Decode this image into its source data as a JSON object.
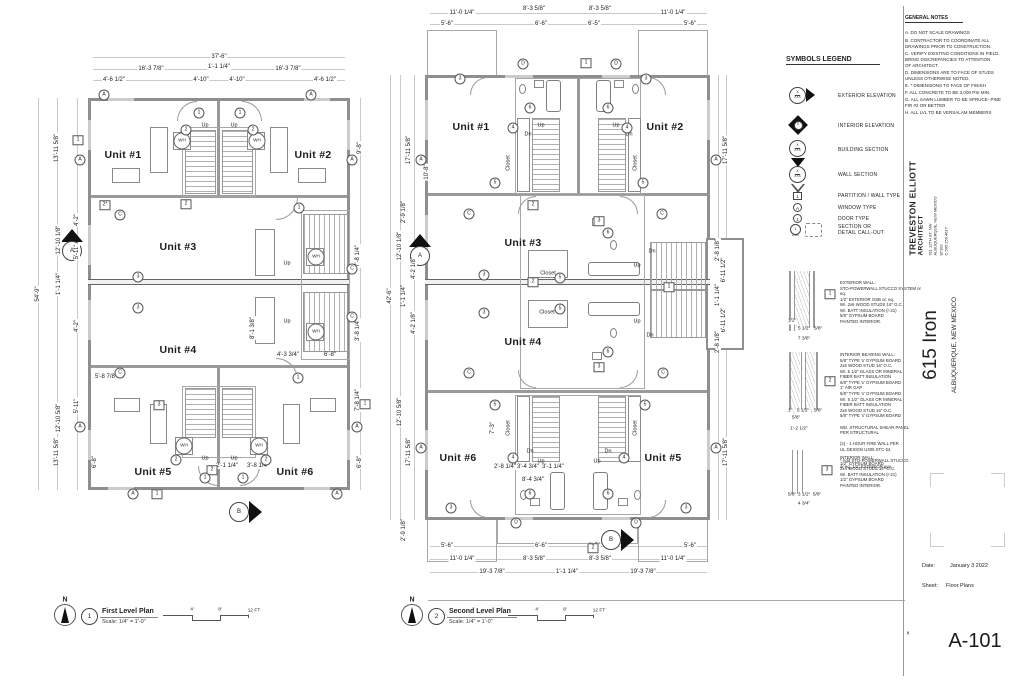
{
  "sheet": {
    "number": "A-101",
    "date_label": "Date:",
    "date_value": "January 3 2022",
    "sheet_label": "Sheet:",
    "sheet_value": "Floor Plans",
    "corner_mark": "x"
  },
  "title_block": {
    "architect_name": "TREVESTON ELLIOTT",
    "architect_role": "ARCHITECT",
    "address_lines": "611 12TH ST. NW\nALBUQUERQUE, NEW MEXICO\n87102\nC 505.259.4617",
    "project_name": "615 Iron",
    "project_location": "ALBUQUERQUE, NEW MEXICO"
  },
  "general_notes": {
    "title": "GENERAL NOTES",
    "items": [
      "A. DO NOT SCALE DRAWINGS",
      "B. CONTRACTOR TO COORDINATE ALL\n      DRAWINGS PRIOR TO CONSTRUCTION.",
      "C. VERIFY EXISTING CONDITIONS IN FIELD.\n      BRING DISCREPANCIES TO ATTENTION\n      OF ARCHITECT.",
      "D. DIMENSIONS ARE TO FACE OF STUDS\n      UNLESS OTHERWISE NOTED.",
      "E. * DIMENSIONS TO FACE OF FINISH",
      "F. ALL CONCRETE TO BE 3,000 PSI MIN.",
      "G. ALL SAWN LUMBER TO BE SPRUCE- PINE\n      FIR #2 OR BETTER",
      "H. ALL LVL TO BE VERSALAM MEMBERS"
    ]
  },
  "symbols_legend": {
    "title": "SYMBOLS LEGEND",
    "items": [
      {
        "label": "EXTERIOR ELEVATION",
        "t": "X",
        "b": "XXX"
      },
      {
        "label": "INTERIOR ELEVATION",
        "t": "X",
        "b": "XXXX"
      },
      {
        "label": "BUILDING SECTION",
        "t": "X",
        "b": "XXX"
      },
      {
        "label": "WALL SECTION",
        "t": "X",
        "b": "XXX"
      },
      {
        "label": "PARTITION / WALL TYPE",
        "tag": "1"
      },
      {
        "label": "WINDOW TYPE",
        "tag": "A"
      },
      {
        "label": "DOOR TYPE",
        "tag": "1"
      },
      {
        "label": "SECTION OR\nDETAIL CALL-OUT",
        "tag": "1",
        "sub": "A-RG"
      }
    ]
  },
  "wall_notes": {
    "n1": "EXTERIOR WALL:\nSTO-POWERWALL STUCCO SYSTEM or eq.\n1/2\" EXTERIOR OSB or. eq.\nW/. 2x6 WOOD STUDS 16\" O.C.\nW/. BATT INSULATION (r-21)\n5/8\" GYPSUM BOARD\nPAINTED INTERIOR.",
    "n2": "INTERIOR BEARING WALL:\n5/8\" TYPE 'x' GYPSUM BOARD\n2x6 WOOD STUD 16\" O.C.\nW/. 5 1/2\" GLASS OR MINERAL\nFIBER BATT INSULATION\n5/8\" TYPE 'x' GYPSUM BOARD\n1\" AIR GAP\n5/8\" TYPE 'x' GYPSUM BOARD\nW/. 5 1/2\" GLASS OR MINERAL\nFIBER BATT INSULATION\n2x6 WOOD STUD 16\" O.C.\n5/8\" TYPE 'x' GYPSUM BOARD\n\nWD. STRUCTURAL SHEAR PANEL\nPER STRUCTURAL\n\n(2) - 1 HOUR FIRE WALL PER\n        UL DESIGN U305 STC 64.\n\n* Add STO-POWERWALL STUCCO\n   or eq. 1/2\" EXTERIOR gyp.",
    "n3": "INTERIOR WALL:\n1/2\" GYPSUM BOARD\n2x4 WOOD STUDS 16\" O.C.\nW/. BATT INSULATION (r-21)\n1/2\" GYPSUM BOARD\nPAINTED INTERIOR."
  },
  "plans": [
    {
      "num": "1",
      "title": "First Level Plan",
      "scale": "Scale: 1/4\" = 1'-0\"",
      "north": "N"
    },
    {
      "num": "2",
      "title": "Second Level Plan",
      "scale": "Scale: 1/4\" = 1'-0\"",
      "north": "N"
    }
  ],
  "labels": [
    [
      "37'-6\"",
      219,
      57,
      "d"
    ],
    [
      "16'-3 7/8\"",
      151,
      69,
      "d"
    ],
    [
      "1'-1 1/4\"",
      219,
      67,
      "d"
    ],
    [
      "16'-3 7/8\"",
      288,
      69,
      "d"
    ],
    [
      "4'-6 1/2\"",
      114,
      80,
      "d"
    ],
    [
      "4'-10\"",
      201,
      80,
      "d"
    ],
    [
      "4'-10\"",
      237,
      80,
      "d"
    ],
    [
      "4'-6 1/2\"",
      325,
      80,
      "d"
    ],
    [
      "13'-11 5/8\"",
      57,
      148,
      "dv"
    ],
    [
      "54'-9\"",
      38,
      294,
      "dv"
    ],
    [
      "4'-2\"",
      77,
      220,
      "dv"
    ],
    [
      "12'-10 1/8\"",
      59,
      240,
      "dv"
    ],
    [
      "5'-11\"",
      77,
      252,
      "dv"
    ],
    [
      "1'-1 1/4\"",
      59,
      284,
      "dv"
    ],
    [
      "4'-2\"",
      77,
      326,
      "dv"
    ],
    [
      "12'-10 5/8\"",
      59,
      418,
      "dv"
    ],
    [
      "5'-11\"",
      77,
      406,
      "dv"
    ],
    [
      "13'-11 5/8\"",
      57,
      452,
      "dv"
    ],
    [
      "6'-8\"",
      95,
      462,
      "dv"
    ],
    [
      "9'-8\"",
      360,
      148,
      "dv"
    ],
    [
      "7'-8 1/4\"",
      358,
      256,
      "dv"
    ],
    [
      "3'-8 1/4\"",
      358,
      330,
      "dv"
    ],
    [
      "7'-8 1/4\"",
      358,
      400,
      "dv"
    ],
    [
      "6'-8\"",
      360,
      462,
      "dv"
    ],
    [
      "5'-8 7/8\"",
      106,
      377,
      "d"
    ],
    [
      "4'-3 3/4\"",
      288,
      355,
      "d"
    ],
    [
      "6'-8\"",
      330,
      355,
      "d"
    ],
    [
      "8'-1 3/8\"",
      253,
      328,
      "dv"
    ],
    [
      "2'-1 1/4\"",
      227,
      466,
      "d"
    ],
    [
      "3'-8 1/4\"",
      258,
      466,
      "d"
    ],
    [
      "Unit #1",
      123,
      155,
      "u"
    ],
    [
      "Unit #2",
      313,
      155,
      "u"
    ],
    [
      "Unit #3",
      178,
      247,
      "u"
    ],
    [
      "Unit #4",
      178,
      350,
      "u"
    ],
    [
      "Unit #5",
      153,
      472,
      "u"
    ],
    [
      "Unit #6",
      295,
      472,
      "u"
    ],
    [
      "Up",
      205,
      126,
      "tx"
    ],
    [
      "Up",
      234,
      126,
      "tx"
    ],
    [
      "Up",
      287,
      264,
      "tx"
    ],
    [
      "Up",
      287,
      322,
      "tx"
    ],
    [
      "Up",
      205,
      459,
      "tx"
    ],
    [
      "Up",
      234,
      459,
      "tx"
    ],
    [
      "WH",
      182,
      141,
      "wh"
    ],
    [
      "WH",
      257,
      141,
      "wh"
    ],
    [
      "WH",
      316,
      257,
      "wh"
    ],
    [
      "WH",
      316,
      332,
      "wh"
    ],
    [
      "WH",
      184,
      446,
      "wh"
    ],
    [
      "WH",
      259,
      446,
      "wh"
    ],
    [
      "1",
      78,
      140,
      "sq"
    ],
    [
      "2*",
      105,
      205,
      "sq"
    ],
    [
      "2",
      186,
      204,
      "sq"
    ],
    [
      "3",
      159,
      405,
      "sq"
    ],
    [
      "1",
      365,
      404,
      "sq"
    ],
    [
      "2",
      212,
      470,
      "sq"
    ],
    [
      "1",
      157,
      494,
      "sq"
    ],
    [
      "A",
      104,
      95,
      "ci"
    ],
    [
      "A",
      311,
      95,
      "ci"
    ],
    [
      "1",
      199,
      113,
      "ci"
    ],
    [
      "1",
      240,
      113,
      "ci"
    ],
    [
      "2",
      186,
      130,
      "ci"
    ],
    [
      "2",
      253,
      130,
      "ci"
    ],
    [
      "A",
      80,
      160,
      "ci"
    ],
    [
      "A",
      352,
      160,
      "ci"
    ],
    [
      "C",
      120,
      215,
      "ci"
    ],
    [
      "3",
      138,
      277,
      "ci"
    ],
    [
      "3",
      138,
      308,
      "ci"
    ],
    [
      "C",
      120,
      373,
      "ci"
    ],
    [
      "C",
      352,
      269,
      "ci"
    ],
    [
      "C",
      352,
      317,
      "ci"
    ],
    [
      "1",
      299,
      208,
      "ci"
    ],
    [
      "1",
      298,
      378,
      "ci"
    ],
    [
      "2",
      176,
      460,
      "ci"
    ],
    [
      "2",
      266,
      460,
      "ci"
    ],
    [
      "1",
      205,
      478,
      "ci"
    ],
    [
      "1",
      243,
      478,
      "ci"
    ],
    [
      "A",
      80,
      427,
      "ci"
    ],
    [
      "A",
      357,
      427,
      "ci"
    ],
    [
      "A",
      133,
      494,
      "ci"
    ],
    [
      "A",
      337,
      494,
      "ci"
    ],
    [
      "A",
      72,
      251,
      "mk"
    ],
    [
      "B",
      239,
      512,
      "mk"
    ],
    [
      "4'",
      192,
      611,
      "st"
    ],
    [
      "8'",
      220,
      611,
      "st"
    ],
    [
      "12 FT",
      254,
      612,
      "st"
    ],
    [
      "11'-0 1/4\"",
      462,
      13,
      "d"
    ],
    [
      "8'-3 5/8\"",
      534,
      9,
      "d"
    ],
    [
      "8'-3 5/8\"",
      600,
      9,
      "d"
    ],
    [
      "11'-0 1/4\"",
      673,
      13,
      "d"
    ],
    [
      "5'-6\"",
      447,
      24,
      "d"
    ],
    [
      "6'-6\"",
      541,
      24,
      "d"
    ],
    [
      "6'-5\"",
      594,
      24,
      "d"
    ],
    [
      "5'-6\"",
      690,
      24,
      "d"
    ],
    [
      "17'-11 5/8\"",
      409,
      150,
      "dv"
    ],
    [
      "10'-8\"",
      427,
      172,
      "dv"
    ],
    [
      "42'-6\"",
      390,
      296,
      "dv"
    ],
    [
      "2'-9 1/8\"",
      404,
      212,
      "dv"
    ],
    [
      "12'-10 1/8\"",
      400,
      246,
      "dv"
    ],
    [
      "4'-2 1/8\"",
      414,
      268,
      "dv"
    ],
    [
      "1'-1 1/4\"",
      404,
      296,
      "dv"
    ],
    [
      "4'-2 1/8\"",
      414,
      323,
      "dv"
    ],
    [
      "12'-10 5/8\"",
      400,
      412,
      "dv"
    ],
    [
      "17'-11 5/8\"",
      409,
      452,
      "dv"
    ],
    [
      "2'-9 1/8\"",
      404,
      530,
      "dv"
    ],
    [
      "17'-11 5/8\"",
      726,
      150,
      "dv"
    ],
    [
      "2'-8 1/8\"",
      718,
      250,
      "dv"
    ],
    [
      "6'-11 1/2\"",
      724,
      270,
      "dv"
    ],
    [
      "1'-1 1/4\"",
      718,
      295,
      "dv"
    ],
    [
      "6'-11 1/2\"",
      724,
      320,
      "dv"
    ],
    [
      "2'-8 1/8\"",
      718,
      342,
      "dv"
    ],
    [
      "17'-11 5/8\"",
      726,
      452,
      "dv"
    ],
    [
      "5'-6\"",
      447,
      546,
      "d"
    ],
    [
      "6'-6\"",
      541,
      546,
      "d"
    ],
    [
      "6'-5\"",
      594,
      546,
      "d"
    ],
    [
      "5'-6\"",
      690,
      546,
      "d"
    ],
    [
      "11'-0 1/4\"",
      462,
      559,
      "d"
    ],
    [
      "8'-3 5/8\"",
      534,
      559,
      "d"
    ],
    [
      "8'-3 5/8\"",
      600,
      559,
      "d"
    ],
    [
      "11'-0 1/4\"",
      673,
      559,
      "d"
    ],
    [
      "19'-3 7/8\"",
      492,
      572,
      "d"
    ],
    [
      "1'-1 1/4\"",
      567,
      572,
      "d"
    ],
    [
      "19'-3 7/8\"",
      643,
      572,
      "d"
    ],
    [
      "Unit #1",
      471,
      127,
      "u"
    ],
    [
      "Unit #2",
      665,
      127,
      "u"
    ],
    [
      "Unit #3",
      523,
      243,
      "u"
    ],
    [
      "Unit #4",
      523,
      342,
      "u"
    ],
    [
      "Unit #6",
      458,
      458,
      "u"
    ],
    [
      "Unit #5",
      663,
      458,
      "u"
    ],
    [
      "Up",
      541,
      126,
      "tx"
    ],
    [
      "Dn",
      528,
      135,
      "tx"
    ],
    [
      "Up",
      616,
      126,
      "tx"
    ],
    [
      "Dn",
      629,
      135,
      "tx"
    ],
    [
      "Dn",
      652,
      252,
      "tx"
    ],
    [
      "Up",
      637,
      266,
      "tx"
    ],
    [
      "Up",
      637,
      322,
      "tx"
    ],
    [
      "Dn",
      650,
      336,
      "tx"
    ],
    [
      "Dn",
      530,
      452,
      "tx"
    ],
    [
      "Up",
      541,
      462,
      "tx"
    ],
    [
      "Dn",
      608,
      452,
      "tx"
    ],
    [
      "Up",
      597,
      462,
      "tx"
    ],
    [
      "Closet",
      509,
      163,
      "txv"
    ],
    [
      "Closet",
      636,
      163,
      "txv"
    ],
    [
      "Closet",
      548,
      274,
      "tx"
    ],
    [
      "Closet",
      547,
      313,
      "tx"
    ],
    [
      "Closet",
      509,
      428,
      "txv"
    ],
    [
      "Closet",
      636,
      428,
      "txv"
    ],
    [
      "2'-8 1/4\"",
      505,
      467,
      "d"
    ],
    [
      "3'-4 3/4\"",
      528,
      467,
      "d"
    ],
    [
      "3'-1 1/4\"",
      553,
      467,
      "d"
    ],
    [
      "8'-4 3/4\"",
      533,
      480,
      "d"
    ],
    [
      "7'-3\"",
      493,
      428,
      "dv"
    ],
    [
      "3",
      460,
      79,
      "ci"
    ],
    [
      "3",
      646,
      79,
      "ci"
    ],
    [
      "D",
      523,
      64,
      "ci"
    ],
    [
      "D",
      616,
      64,
      "ci"
    ],
    [
      "6",
      530,
      108,
      "ci"
    ],
    [
      "6",
      608,
      108,
      "ci"
    ],
    [
      "4",
      513,
      128,
      "ci"
    ],
    [
      "4",
      627,
      128,
      "ci"
    ],
    [
      "5",
      495,
      183,
      "ci"
    ],
    [
      "5",
      643,
      183,
      "ci"
    ],
    [
      "A",
      421,
      160,
      "ci"
    ],
    [
      "A",
      716,
      160,
      "ci"
    ],
    [
      "C",
      469,
      214,
      "ci"
    ],
    [
      "C",
      662,
      214,
      "ci"
    ],
    [
      "3",
      484,
      275,
      "ci"
    ],
    [
      "3",
      484,
      313,
      "ci"
    ],
    [
      "5",
      560,
      278,
      "ci"
    ],
    [
      "5",
      560,
      309,
      "ci"
    ],
    [
      "6",
      608,
      233,
      "ci"
    ],
    [
      "6",
      608,
      352,
      "ci"
    ],
    [
      "C",
      469,
      373,
      "ci"
    ],
    [
      "C",
      663,
      373,
      "ci"
    ],
    [
      "A",
      421,
      448,
      "ci"
    ],
    [
      "A",
      716,
      448,
      "ci"
    ],
    [
      "5",
      495,
      405,
      "ci"
    ],
    [
      "5",
      645,
      405,
      "ci"
    ],
    [
      "4",
      513,
      458,
      "ci"
    ],
    [
      "4",
      624,
      458,
      "ci"
    ],
    [
      "6",
      530,
      494,
      "ci"
    ],
    [
      "6",
      608,
      494,
      "ci"
    ],
    [
      "3",
      451,
      508,
      "ci"
    ],
    [
      "3",
      686,
      508,
      "ci"
    ],
    [
      "D",
      516,
      523,
      "ci"
    ],
    [
      "D",
      636,
      523,
      "ci"
    ],
    [
      "1",
      586,
      63,
      "sq"
    ],
    [
      "3",
      599,
      221,
      "sq"
    ],
    [
      "2",
      533,
      205,
      "sq"
    ],
    [
      "2",
      533,
      282,
      "sq"
    ],
    [
      "1",
      669,
      287,
      "sq"
    ],
    [
      "3",
      599,
      367,
      "sq"
    ],
    [
      "2",
      593,
      548,
      "sq"
    ],
    [
      "A",
      420,
      256,
      "mk"
    ],
    [
      "B",
      611,
      540,
      "mk"
    ],
    [
      "4'",
      537,
      611,
      "st"
    ],
    [
      "8'",
      565,
      611,
      "st"
    ],
    [
      "12 FT",
      599,
      612,
      "st"
    ],
    [
      "1/2\"",
      792,
      322,
      "st"
    ],
    [
      "5 1/2\"",
      804,
      330,
      "st"
    ],
    [
      "5/8\"",
      818,
      330,
      "st"
    ],
    [
      "7 3/8\"",
      804,
      340,
      "st"
    ],
    [
      "1\"",
      790,
      412,
      "st"
    ],
    [
      "5 1/2\"",
      803,
      412,
      "st"
    ],
    [
      "5/8\"",
      818,
      412,
      "st"
    ],
    [
      "5/8\"",
      796,
      419,
      "st"
    ],
    [
      "1'-2 1/2\"",
      799,
      430,
      "st"
    ],
    [
      "5/8\"",
      792,
      496,
      "st"
    ],
    [
      "3 1/2\"",
      804,
      496,
      "st"
    ],
    [
      "5/8\"",
      817,
      496,
      "st"
    ],
    [
      "4 3/4\"",
      804,
      505,
      "st"
    ],
    [
      "1",
      830,
      294,
      "sq"
    ],
    [
      "2",
      830,
      381,
      "sq"
    ],
    [
      "3",
      827,
      470,
      "sq"
    ],
    [
      "x",
      908,
      634,
      "tx"
    ]
  ]
}
